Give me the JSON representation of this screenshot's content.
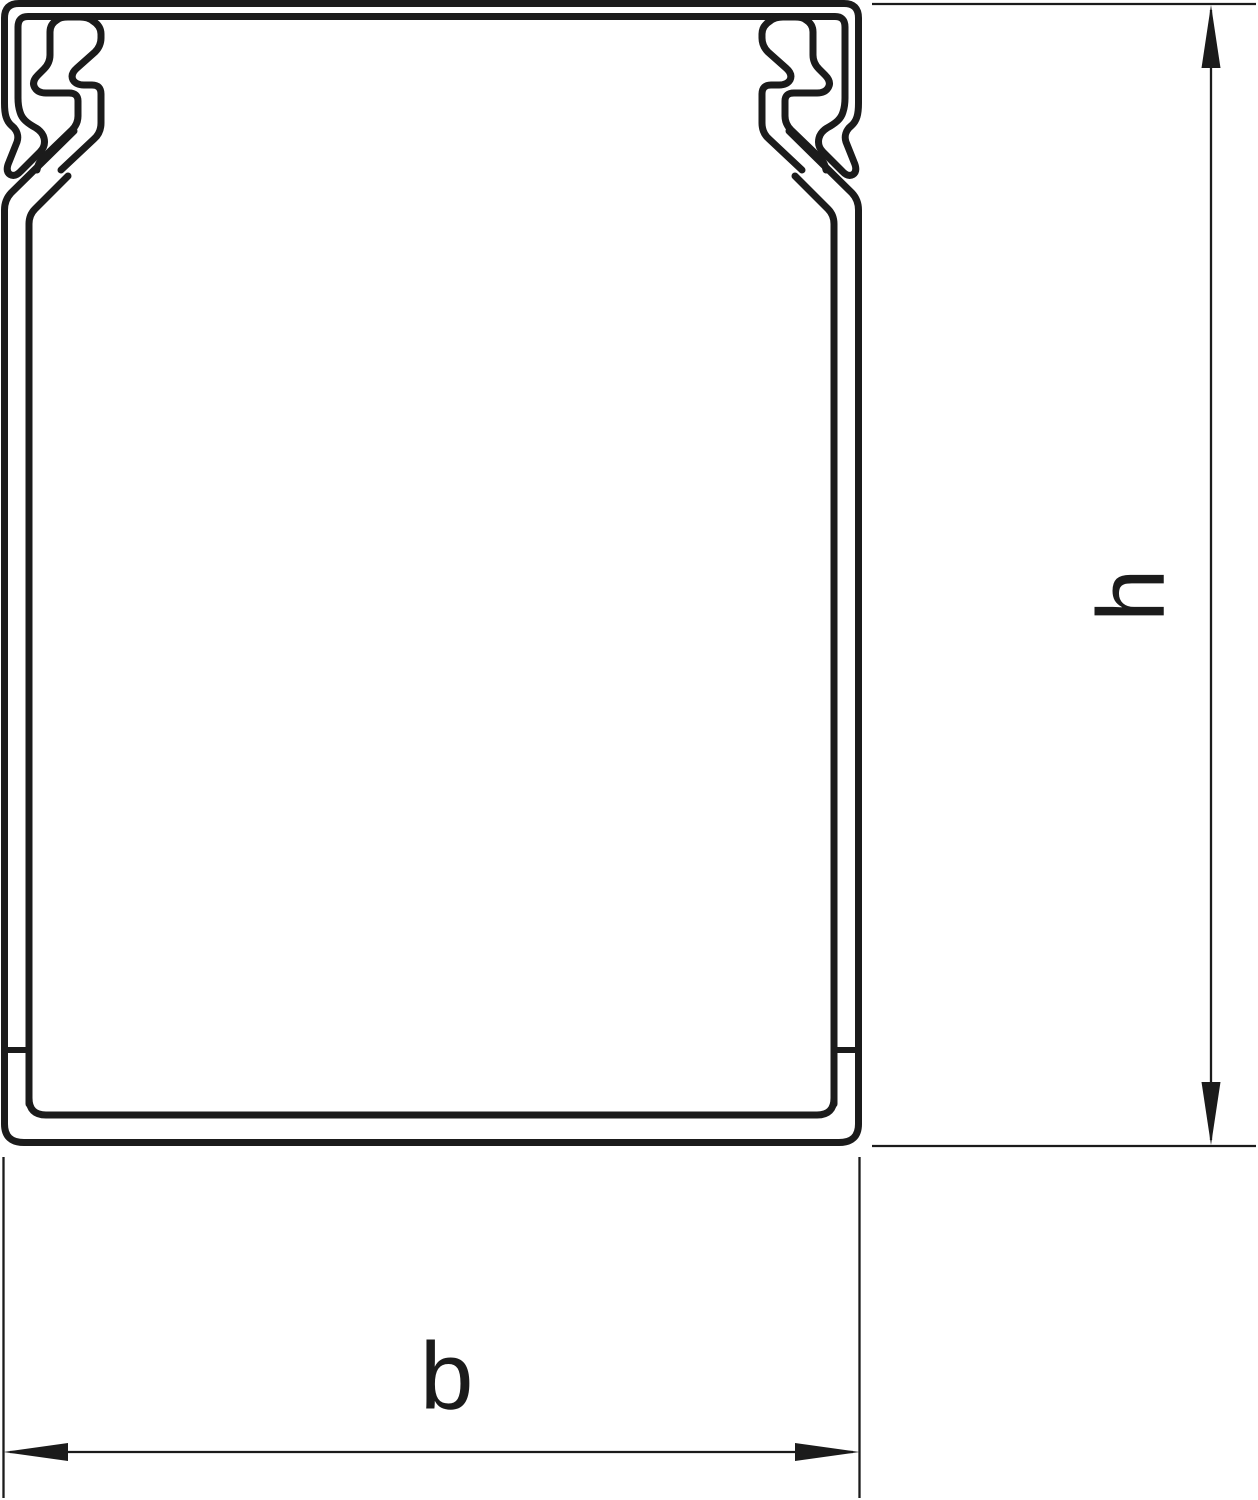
{
  "figure": {
    "description": "Cross-section profile drawing of a cable trunking duct with snap-on lid latches",
    "background_color": "#ffffff",
    "line_color": "#1b1b1b"
  },
  "dimensions": {
    "height": {
      "label": "h",
      "orientation": "vertical"
    },
    "width": {
      "label": "b",
      "orientation": "horizontal"
    }
  }
}
